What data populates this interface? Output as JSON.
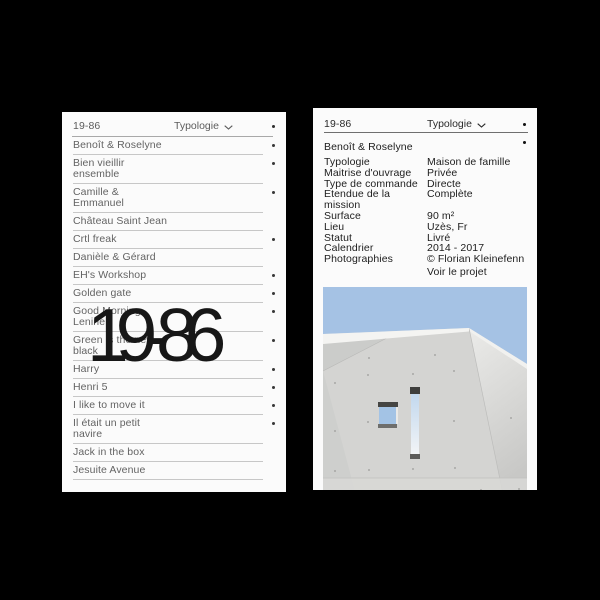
{
  "colors": {
    "background": "#000000",
    "card": "#fbfbfb",
    "left_text": "#636363",
    "right_text": "#1d1d1d",
    "divider": "#c7c7c7",
    "sky": "#a5c2e4",
    "concrete": "#d4d4d2"
  },
  "left_card": {
    "header": {
      "brand": "19-86",
      "dropdown_label": "Typologie"
    },
    "overlay_title": "19-86",
    "items": [
      {
        "label": "Benoît & Roselyne",
        "bullet": true
      },
      {
        "label": "Bien vieillir\nensemble",
        "bullet": true
      },
      {
        "label": "Camille &\nEmmanuel",
        "bullet": true
      },
      {
        "label": "Château Saint Jean",
        "bullet": false
      },
      {
        "label": "Crtl freak",
        "bullet": true
      },
      {
        "label": "Danièle & Gérard",
        "bullet": false
      },
      {
        "label": "EH's Workshop",
        "bullet": true
      },
      {
        "label": "Golden gate",
        "bullet": true
      },
      {
        "label": "Good Morning\nLenine",
        "bullet": true
      },
      {
        "label": "Green is the new\nblack",
        "bullet": true
      },
      {
        "label": "Harry",
        "bullet": true
      },
      {
        "label": "Henri 5",
        "bullet": true
      },
      {
        "label": "I like to move it",
        "bullet": true
      },
      {
        "label": "Il était un petit\nnavire",
        "bullet": true
      },
      {
        "label": "Jack in the box",
        "bullet": false
      },
      {
        "label": "Jesuite Avenue",
        "bullet": false
      }
    ]
  },
  "right_card": {
    "header": {
      "brand": "19-86",
      "dropdown_label": "Typologie"
    },
    "project_title": "Benoît & Roselyne",
    "details": [
      {
        "label": "Typologie",
        "value": "Maison de famille"
      },
      {
        "label": "Maitrise d'ouvrage",
        "value": "Privée"
      },
      {
        "label": "Type de commande",
        "value": "Directe"
      },
      {
        "label": "Etendue de la mission",
        "value": "Complète"
      },
      {
        "label": "Surface",
        "value": "90 m²"
      },
      {
        "label": "Lieu",
        "value": "Uzès, Fr"
      },
      {
        "label": "Statut",
        "value": "Livré"
      },
      {
        "label": "Calendrier",
        "value": "2014 - 2017"
      },
      {
        "label": "Photographies",
        "value": "© Florian Kleinefenn"
      },
      {
        "label": "",
        "value": "Voir le projet"
      }
    ],
    "photo": {
      "alt": "concrete-house-facade",
      "sky_color": "#a5c2e4",
      "concrete_color": "#d4d4d2"
    }
  }
}
